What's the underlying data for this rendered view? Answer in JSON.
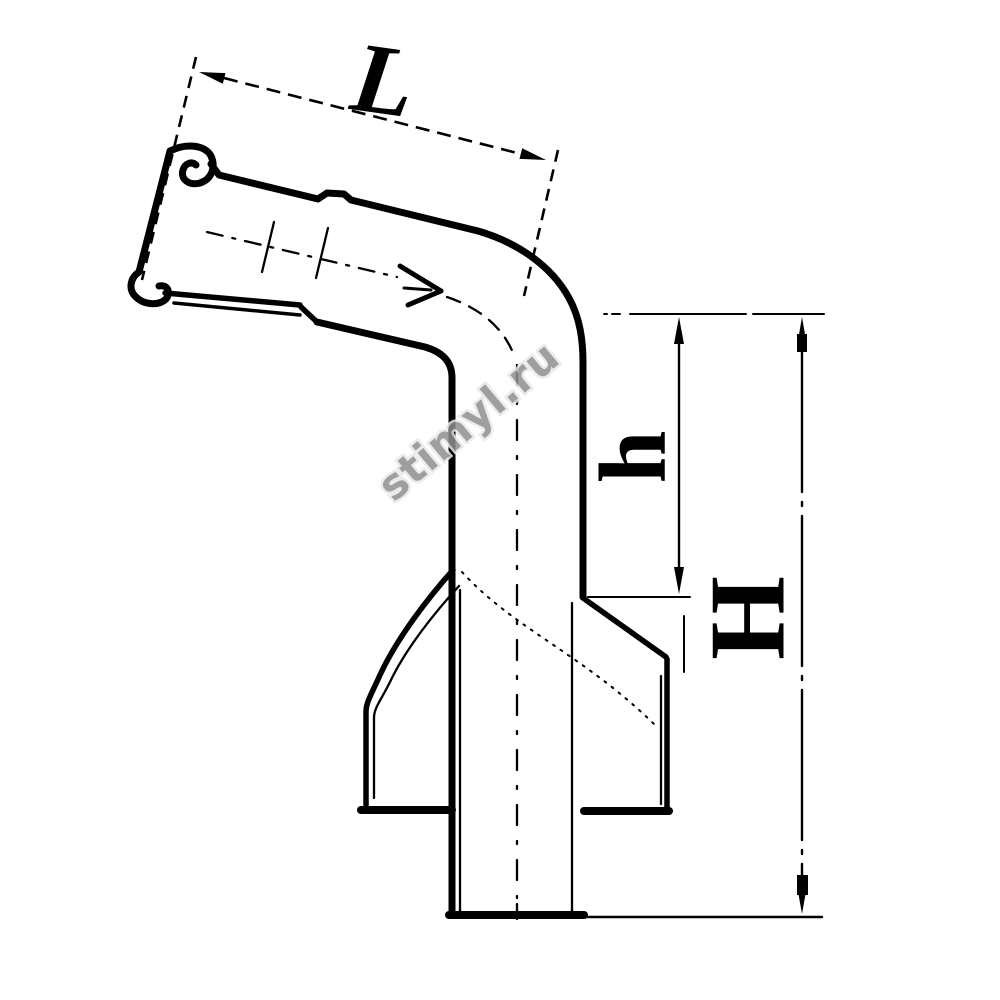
{
  "figure": {
    "type": "technical-line-drawing",
    "subject": "angled pipe outlet connector (elbow with socket inlet, vertical outlet and sealing skirt), side view with dimensions",
    "background_color": "#ffffff",
    "line_color": "#000000",
    "labels": {
      "length_dimension": "L",
      "small_height_dimension": "h",
      "total_height_dimension": "H"
    },
    "watermark": {
      "text": "stimyl.ru",
      "color": "#8f8f8f"
    }
  }
}
